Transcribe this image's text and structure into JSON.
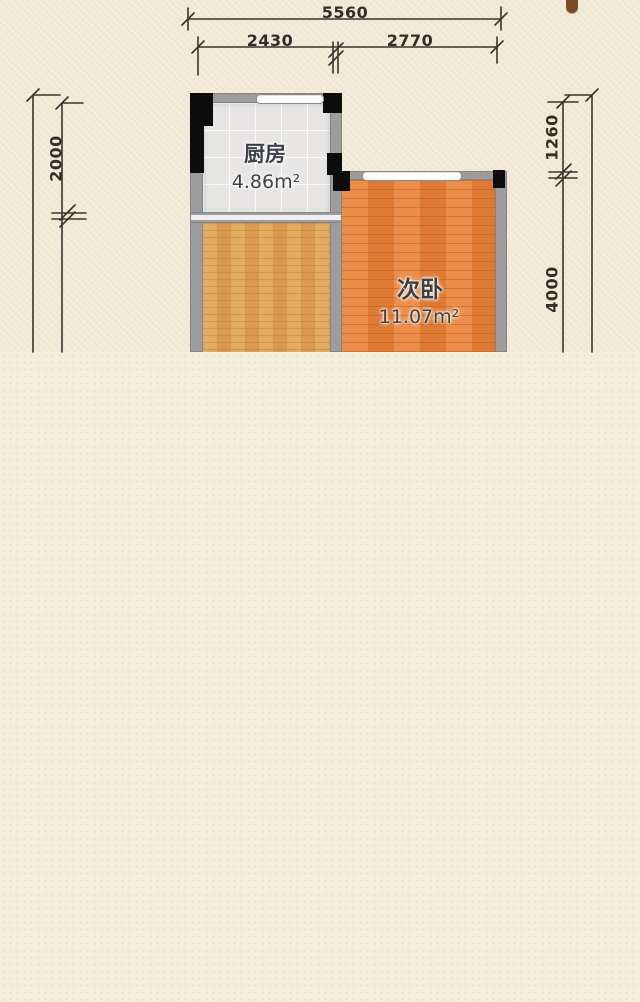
{
  "plan": {
    "rooms": [
      {
        "id": "kitchen",
        "name": "厨房",
        "area_label": "4.86m²"
      },
      {
        "id": "bedroom2",
        "name": "次卧",
        "area_label": "11.07m²"
      }
    ],
    "dimensions": {
      "top_total": "5560",
      "top_left_segment": "2430",
      "top_right_segment": "2770",
      "left_segment": "2000",
      "right_upper_segment": "1260",
      "right_lower_segment": "4000"
    },
    "colors": {
      "background_upper": "#f1e9d6",
      "background_lower": "#f4eedd",
      "wall": "#9d9d9d",
      "pillar": "#0d0d0d",
      "kitchen_floor": "#e7e6e4",
      "living_floor": "#dfa053",
      "bedroom_floor": "#e8813a",
      "dimension_ink": "#39342c",
      "label_ink": "#3e4145",
      "window_fill": "#fdfdfd"
    }
  }
}
